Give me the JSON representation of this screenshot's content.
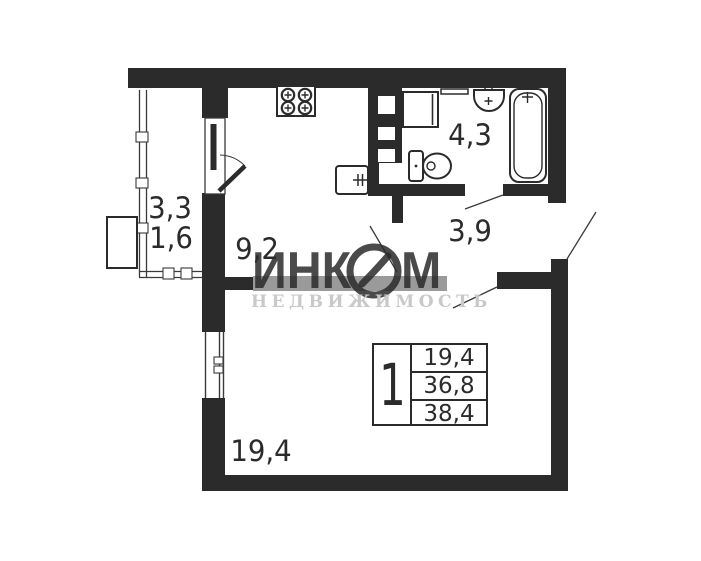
{
  "plan": {
    "rooms": [
      {
        "id": "balcony-area-1",
        "label": "3,3"
      },
      {
        "id": "balcony-area-2",
        "label": "1,6"
      },
      {
        "id": "kitchen",
        "label": "9,2"
      },
      {
        "id": "bathroom",
        "label": "4,3"
      },
      {
        "id": "hallway",
        "label": "3,9"
      },
      {
        "id": "living-room",
        "label": "19,4"
      }
    ],
    "fixtures": [
      "stove-icon",
      "kitchen-sink-icon",
      "washing-machine-icon",
      "shelf-icon",
      "bathroom-sink-icon",
      "bathtub-icon",
      "toilet-icon",
      "vent-shaft",
      "ac-unit",
      "balcony-door",
      "living-room-window",
      "balcony-windows"
    ]
  },
  "info_table": {
    "rooms_count": "1",
    "rows": [
      "19,4",
      "36,8",
      "38,4"
    ]
  },
  "watermark": {
    "brand_part1": "ИНК",
    "brand_part2": "М",
    "subtitle": "НЕДВИЖИМОСТЬ",
    "band_color": "#9a9a9a",
    "subtitle_color": "#c9c9c9"
  },
  "colors": {
    "wall": "#2b2b2b",
    "thin_line": "#3a3a3a",
    "background": "#ffffff"
  }
}
